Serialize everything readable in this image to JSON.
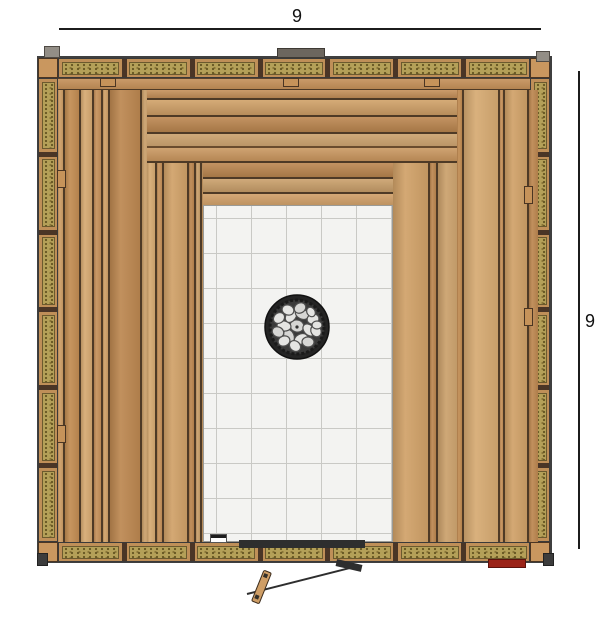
{
  "drawing": {
    "type": "sauna-floor-plan-top-view"
  },
  "dimensions": {
    "top": {
      "label": "9",
      "x1": 59,
      "y": 28,
      "x2": 541,
      "label_x": 292,
      "label_y": 7
    },
    "right": {
      "label": "9",
      "x": 578,
      "y1": 71,
      "y2": 549,
      "label_x": 585,
      "label_y": 312
    }
  },
  "colors": {
    "line": "#1c1c1c",
    "wood_gap": "#4e3a26",
    "insulation": "#b4a058",
    "stud": "#4a3526",
    "tile": "#f3f3f1",
    "grout": "#c9c9c5",
    "heater_ring": "#242424",
    "heater_inner": "#3a3a3a",
    "stone": "#e4e4e2",
    "stone_alt": "#d6d6d4",
    "stone_outline": "#4e4e4e",
    "red_marker": "#9b2318",
    "gray_cap": "#938e86",
    "dark_tab": "#3c3c3c",
    "door_line": "#2e2e2e",
    "notch_wood": "#c6935a",
    "drain_body": "#ffffff",
    "drain_top": "#1e1e1e"
  },
  "wood_palette": [
    "#cf9e66",
    "#c28c52",
    "#d6aa72",
    "#c6915a",
    "#d0a168",
    "#bc8750",
    "#caa06b"
  ],
  "structure": {
    "outline": {
      "x": 37,
      "y": 56,
      "w": 515,
      "h": 507
    },
    "walls": {
      "top": {
        "x": 58,
        "y": 58,
        "w": 472,
        "h": 20,
        "batts": 7,
        "dir": "row"
      },
      "bottom": {
        "x": 58,
        "y": 542,
        "w": 472,
        "h": 20,
        "batts": 7,
        "dir": "row"
      },
      "left": {
        "x": 38,
        "y": 78,
        "w": 20,
        "h": 464,
        "batts": 6,
        "dir": "column"
      },
      "right": {
        "x": 530,
        "y": 78,
        "w": 20,
        "h": 464,
        "batts": 6,
        "dir": "column"
      }
    },
    "corners": [
      [
        38,
        58
      ],
      [
        530,
        58
      ],
      [
        38,
        542
      ],
      [
        530,
        542
      ]
    ],
    "corner_size": 20,
    "top_frame": {
      "x": 58,
      "y": 78,
      "w": 472,
      "h": 13
    },
    "panels": [
      {
        "name": "bench-panel-left",
        "x": 58,
        "y": 90,
        "w": 89,
        "h": 452,
        "planks": [
          5,
          14,
          11,
          7,
          5,
          30,
          8,
          9
        ],
        "offset": 0
      },
      {
        "name": "bench-panel-left-inner",
        "x": 147,
        "y": 163,
        "w": 56,
        "h": 379,
        "planks": [
          8,
          5,
          23,
          5,
          4,
          11
        ],
        "offset": 2
      },
      {
        "name": "bench-panel-right-inner",
        "x": 393,
        "y": 163,
        "w": 64,
        "h": 379,
        "planks": [
          35,
          6,
          23
        ],
        "offset": 4
      },
      {
        "name": "bench-panel-right",
        "x": 457,
        "y": 90,
        "w": 73,
        "h": 452,
        "planks": [
          5,
          34,
          3,
          22,
          9
        ],
        "offset": 1
      }
    ],
    "benches": [
      {
        "name": "upper-bench",
        "x": 147,
        "y": 90,
        "w": 310,
        "h": 56,
        "slats": [
          8,
          15,
          15,
          18
        ],
        "offset": 3
      },
      {
        "name": "lower-bench",
        "x": 203,
        "y": 163,
        "w": 190,
        "h": 42,
        "slats": [
          14,
          13,
          15
        ],
        "offset": 5
      }
    ],
    "shelf_edge": {
      "x": 147,
      "y": 146,
      "w": 310,
      "h": 17
    },
    "tile_floor": {
      "x": 203,
      "y": 205,
      "w": 190,
      "h": 337,
      "grid": 35,
      "offset": 12
    },
    "heater": {
      "cx": 297,
      "cy": 327,
      "r": 32,
      "stones": [
        [
          0,
          -1,
          7,
          6,
          15
        ],
        [
          12,
          3,
          7,
          5,
          45
        ],
        [
          4,
          12,
          7,
          5,
          -25
        ],
        [
          -8,
          9,
          7,
          5,
          65
        ],
        [
          -13,
          -1,
          7,
          5,
          10
        ],
        [
          -6,
          -11,
          7,
          5,
          -55
        ],
        [
          5,
          -13,
          7,
          5,
          25
        ],
        [
          16,
          -8,
          6,
          5,
          -15
        ],
        [
          19,
          4,
          6,
          5,
          60
        ],
        [
          11,
          15,
          6,
          5,
          5
        ],
        [
          -2,
          19,
          6,
          5,
          40
        ],
        [
          -13,
          14,
          6,
          5,
          -20
        ],
        [
          -19,
          5,
          6,
          5,
          30
        ],
        [
          -18,
          -9,
          6,
          5,
          -40
        ],
        [
          -9,
          -17,
          6,
          5,
          20
        ],
        [
          3,
          -19,
          6,
          5,
          -30
        ],
        [
          14,
          -15,
          5,
          4,
          55
        ],
        [
          20,
          -2,
          5,
          4,
          0
        ]
      ]
    },
    "markers": [
      {
        "name": "corner-cap-left",
        "style": "cap",
        "x": 44,
        "y": 46,
        "w": 16,
        "h": 12
      },
      {
        "name": "corner-cap-right",
        "style": "cap",
        "x": 536,
        "y": 51,
        "w": 14,
        "h": 11
      },
      {
        "name": "roof-vent-tab",
        "style": "tab",
        "x": 277,
        "y": 48,
        "w": 48,
        "h": 10
      },
      {
        "name": "corner-foot-left",
        "style": "dark",
        "x": 37,
        "y": 553,
        "w": 11,
        "h": 13
      },
      {
        "name": "corner-foot-right",
        "style": "dark",
        "x": 543,
        "y": 553,
        "w": 11,
        "h": 13
      },
      {
        "name": "red-marker",
        "style": "red",
        "x": 488,
        "y": 559,
        "w": 38,
        "h": 9
      },
      {
        "name": "frame-notch",
        "style": "notch",
        "x": 100,
        "y": 78,
        "w": 16,
        "h": 9
      },
      {
        "name": "frame-notch",
        "style": "notch",
        "x": 283,
        "y": 78,
        "w": 16,
        "h": 9
      },
      {
        "name": "frame-notch",
        "style": "notch",
        "x": 424,
        "y": 78,
        "w": 16,
        "h": 9
      },
      {
        "name": "wall-block",
        "style": "notch",
        "x": 57,
        "y": 170,
        "w": 9,
        "h": 18
      },
      {
        "name": "wall-block",
        "style": "notch",
        "x": 57,
        "y": 425,
        "w": 9,
        "h": 18
      },
      {
        "name": "wall-block",
        "style": "notch",
        "x": 524,
        "y": 186,
        "w": 9,
        "h": 18
      },
      {
        "name": "wall-block",
        "style": "notch",
        "x": 524,
        "y": 308,
        "w": 9,
        "h": 18
      },
      {
        "name": "floor-drain",
        "style": "drain",
        "x": 210,
        "y": 534,
        "w": 17,
        "h": 9
      },
      {
        "name": "door-threshold",
        "style": "threshold",
        "x": 239,
        "y": 540,
        "w": 126,
        "h": 8
      }
    ],
    "door": {
      "leaf": {
        "x": 247,
        "y": 593,
        "len": 114,
        "angle": -14.2
      },
      "hinge": {
        "x": 336,
        "y": 562,
        "w": 26,
        "h": 7,
        "angle": 13
      },
      "handle": {
        "x": 257,
        "y": 570,
        "w": 9,
        "h": 34,
        "angle": 22
      }
    }
  }
}
